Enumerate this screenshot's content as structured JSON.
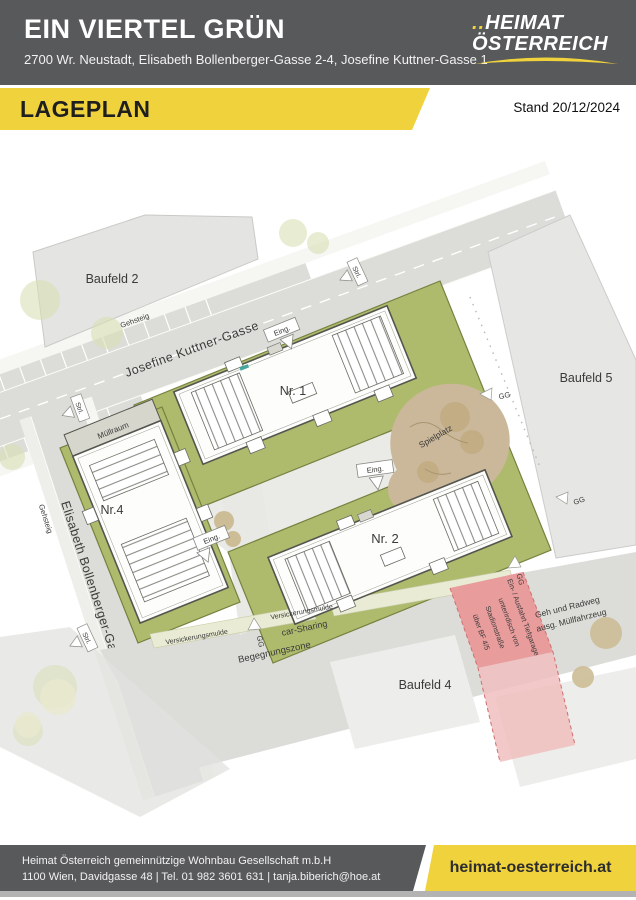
{
  "header": {
    "title": "EIN VIERTEL GRÜN",
    "subtitle": "2700 Wr. Neustadt, Elisabeth Bollenberger-Gasse 2-4, Josefine Kuttner-Gasse 1",
    "logo": {
      "dots": "..",
      "line1": "HEIMAT",
      "line2": "ÖSTERREICH"
    }
  },
  "banner": {
    "title": "LAGEPLAN",
    "date": "Stand 20/12/2024"
  },
  "plan": {
    "fields": {
      "baufeld2": "Baufeld 2",
      "baufeld4": "Baufeld 4",
      "baufeld5": "Baufeld 5"
    },
    "streets": {
      "kuttner": "Josefine Kuttner-Gasse",
      "bollenberger": "Elisabeth Bollenberger-Gasse",
      "gehsteig": "Gehsteig",
      "begegnungszone": "Begegnungszone",
      "geh_radweg_line1": "Geh und Radweg",
      "geh_radweg_line2": "ausg. Müllfahrzeug"
    },
    "buildings": {
      "nr1": "Nr. 1",
      "nr2": "Nr. 2",
      "nr4": "Nr.4",
      "muellraum": "Müllraum"
    },
    "features": {
      "spielplatz": "Spielplatz",
      "versickerungsmulde": "Versickerungsmulde",
      "car_sharing": "car-Sharing",
      "eingang": "Eing.",
      "strassenleuchte": "Strl.",
      "gg": "GG"
    },
    "tiefgarage": {
      "line1": "Ein- / Ausfahrt Tiefgarage",
      "line2": "unterirdisch von",
      "line3": "Stadionstraße",
      "line4": "über BF 4/5"
    },
    "colors": {
      "accent_yellow": "#efd23c",
      "header_gray": "#58595b",
      "parcel_green": "#aebb6d",
      "street_gray": "#dcddd9",
      "block_gray": "#e4e4e2",
      "spielplatz_tan": "#cbb89a",
      "tiefgarage_red": "#e89c9c"
    }
  },
  "footer": {
    "line1": "Heimat Österreich gemeinnützige Wohnbau Gesellschaft m.b.H",
    "line2": "1100 Wien, Davidgasse 48 | Tel. 01 982 3601 631 | tanja.biberich@hoe.at",
    "website": "heimat-oesterreich.at"
  }
}
